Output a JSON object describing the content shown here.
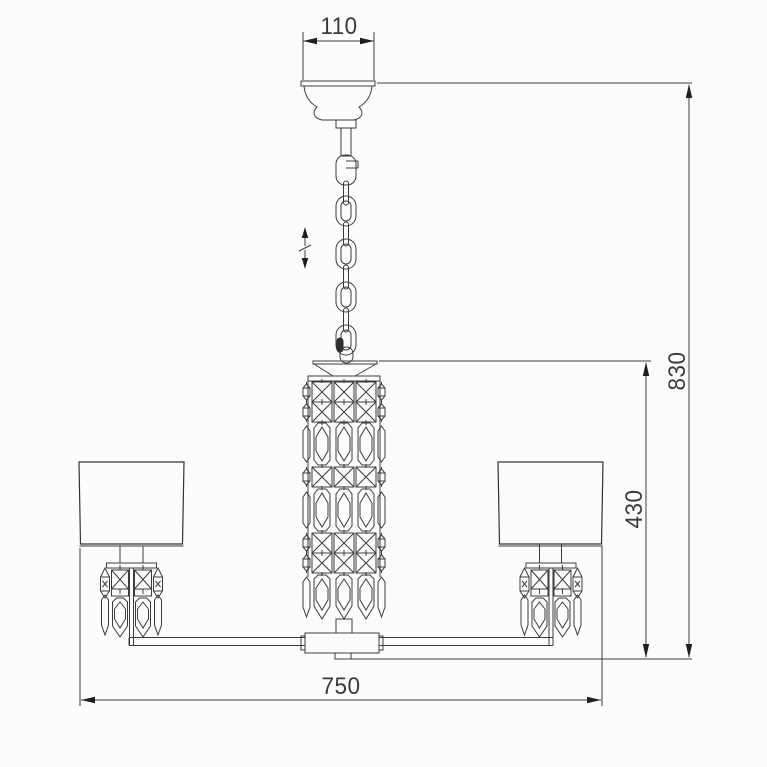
{
  "drawing": {
    "subject": "chandelier suspension technical line drawing",
    "dimensions": {
      "canopy_width": "110",
      "overall_height": "830",
      "body_height": "430",
      "overall_width": "750"
    },
    "symbols": {
      "height_adjustable_icon": "vertical-double-arrow-with-slash"
    },
    "colors": {
      "line": "#3b3b3b",
      "text": "#3a3a3a",
      "arrow": "#1f1f1f",
      "background": "#fcfcfc"
    }
  }
}
